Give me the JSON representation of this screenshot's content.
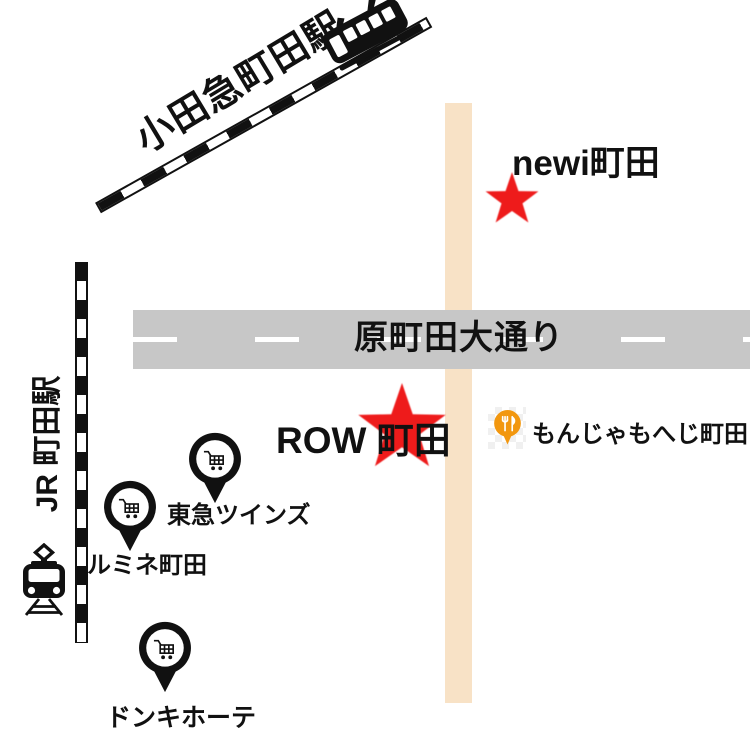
{
  "title": "Machida area access map",
  "colors": {
    "ink": "#111111",
    "road_gray": "#c7c7c7",
    "road_beige": "#f8e2c6",
    "star_red": "#ee1b1b",
    "restaurant_orange": "#f2970f"
  },
  "stations": {
    "odakyu": {
      "label": "小田急町田駅",
      "icon": "tram-side-icon"
    },
    "jr": {
      "label": "JR 町田駅",
      "icon": "train-front-icon"
    }
  },
  "roads": {
    "main_street": {
      "label": "原町田大通り"
    }
  },
  "places": {
    "newi": {
      "label": "newi町田",
      "marker": "red-star"
    },
    "row": {
      "label": "ROW 町田",
      "marker": "red-star"
    },
    "monja": {
      "label": "もんじゃもへじ町田",
      "marker": "restaurant-pin"
    },
    "tokyu_twins": {
      "label": "東急ツインズ",
      "marker": "cart-pin"
    },
    "lumine": {
      "label": "ルミネ町田",
      "marker": "cart-pin"
    },
    "donki": {
      "label": "ドンキホーテ",
      "marker": "cart-pin"
    }
  }
}
